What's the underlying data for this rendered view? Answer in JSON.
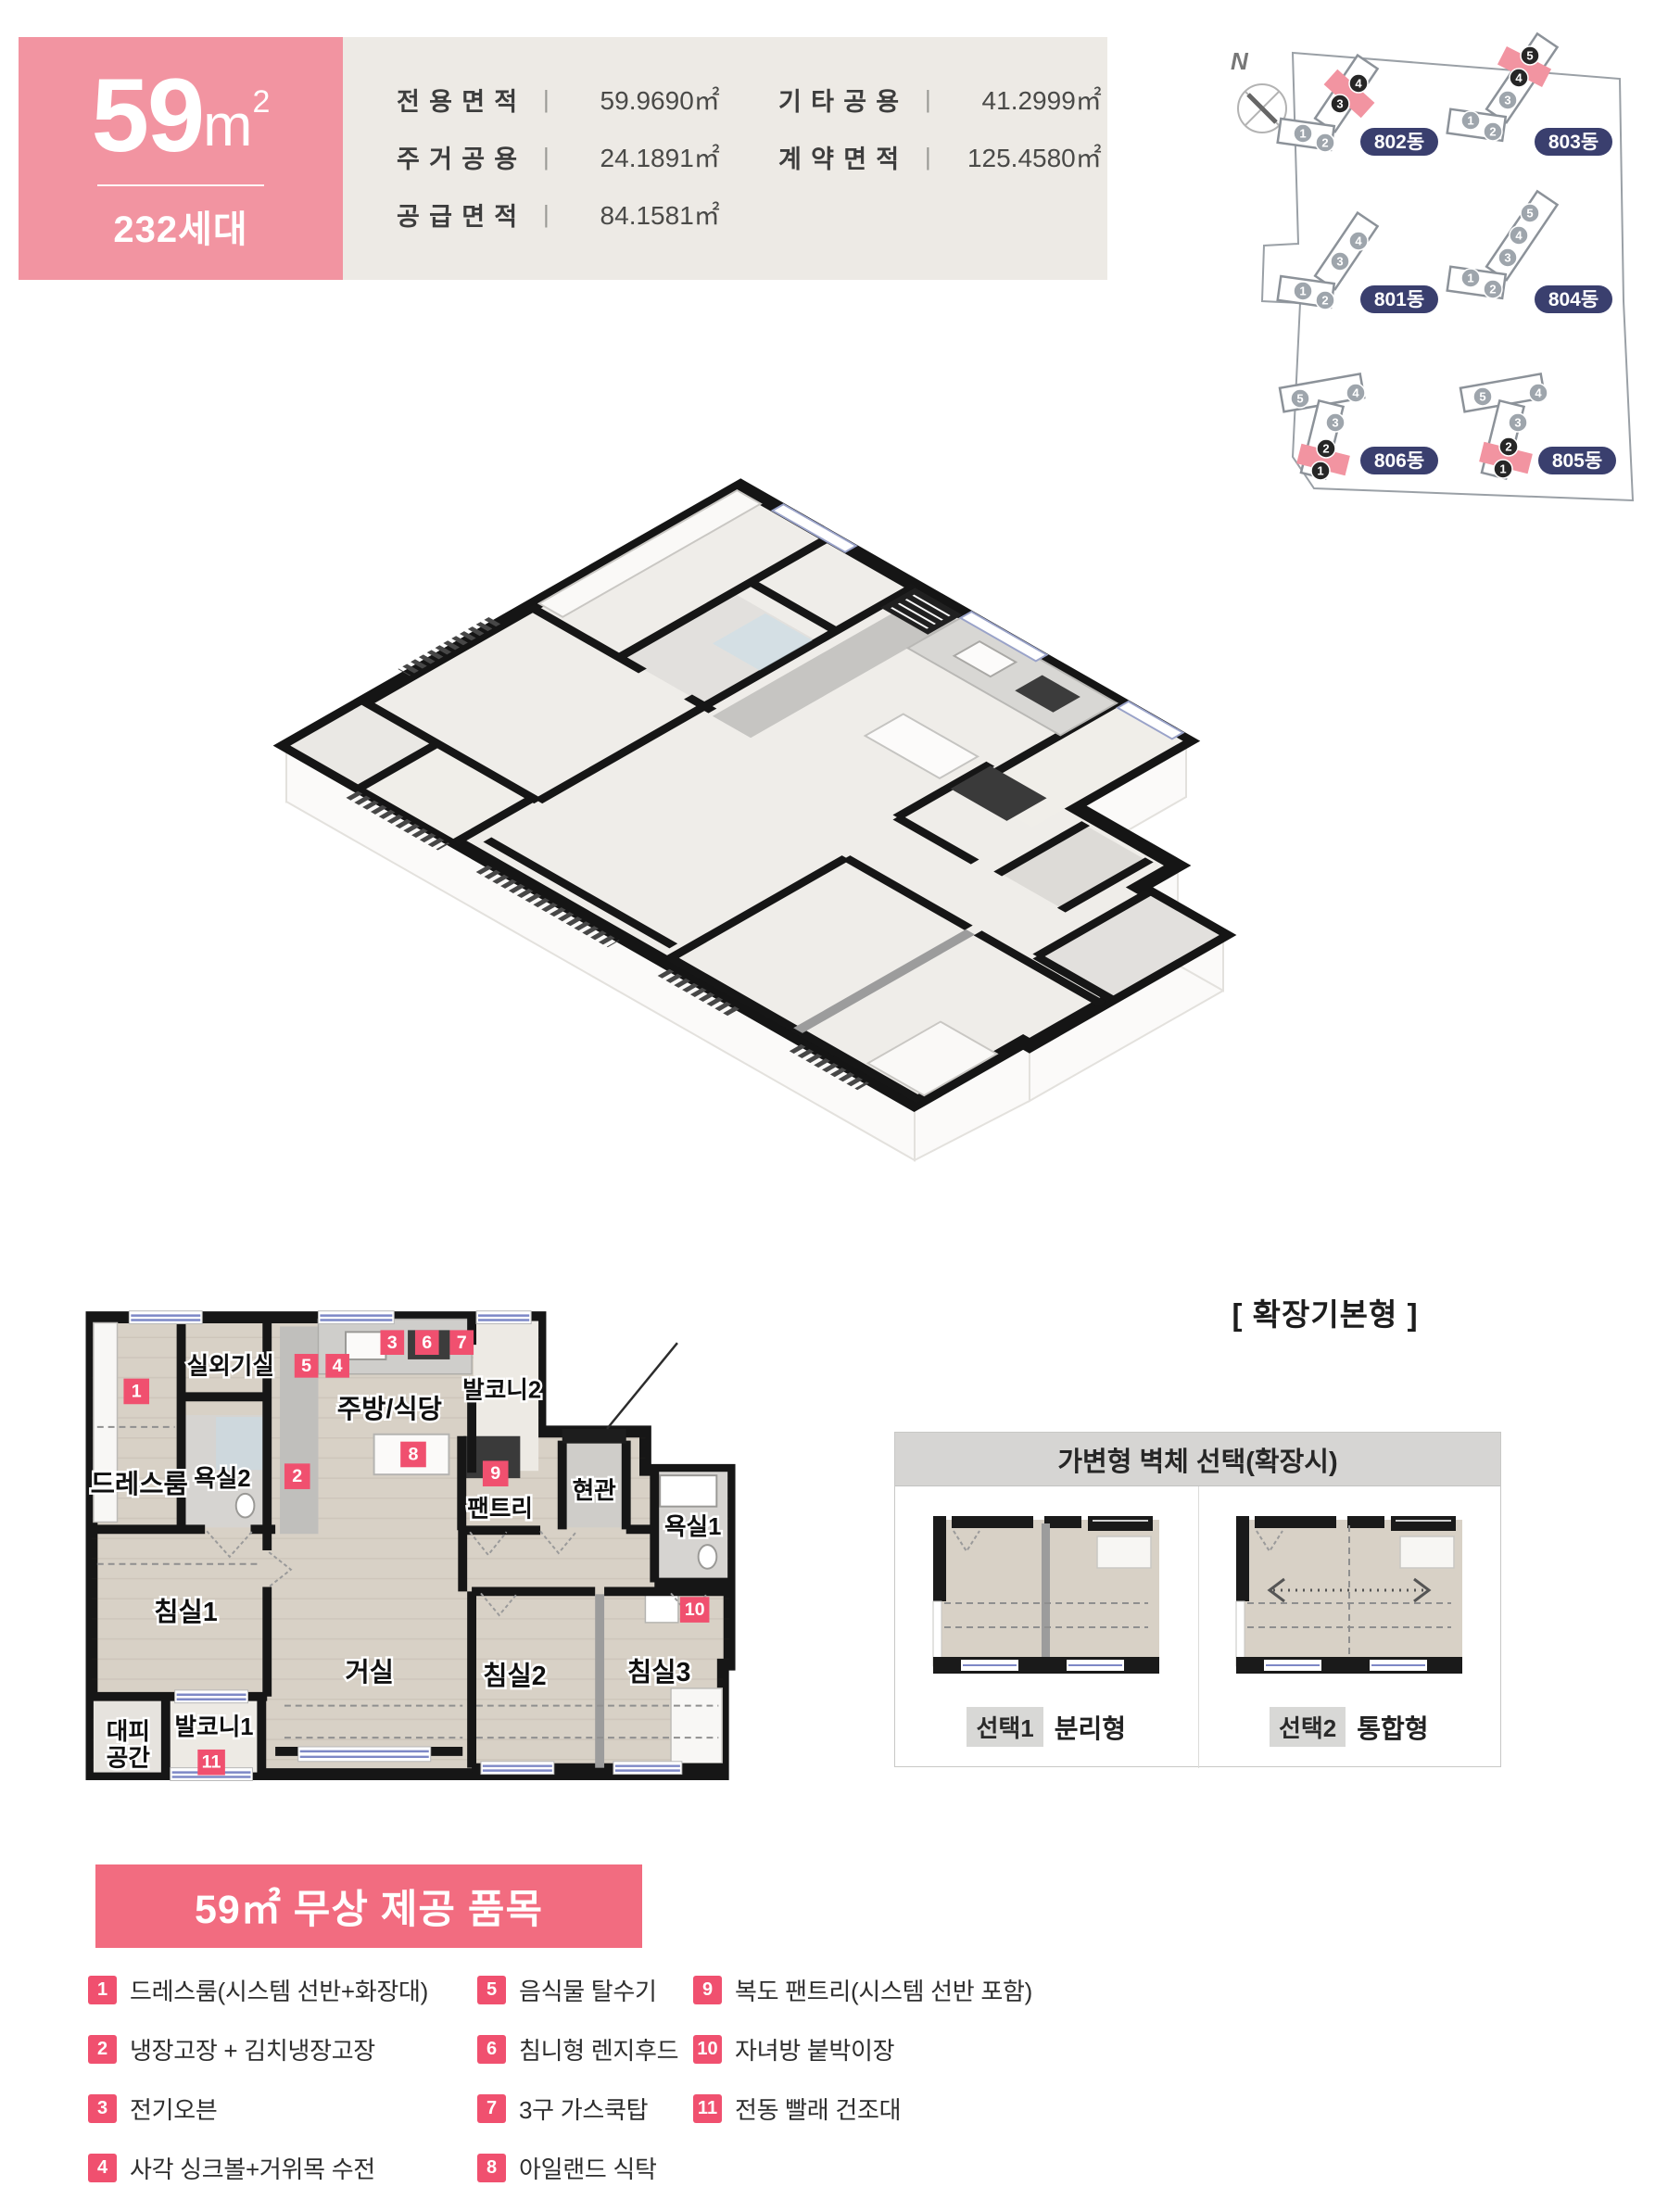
{
  "theme": {
    "accent_pink": "#F294A1",
    "marker_pink": "#F0506F",
    "title_bar_pink": "#F26C80",
    "badge_navy": "#3A3F6E",
    "panel_beige": "#EDEAE5"
  },
  "header": {
    "area_value": "59",
    "area_unit": "m",
    "area_sup": "2",
    "units_count": "232세대",
    "info_left": [
      {
        "label": "전용면적",
        "value": "59.9690㎡"
      },
      {
        "label": "주거공용",
        "value": "24.1891㎡"
      },
      {
        "label": "공급면적",
        "value": "84.1581㎡"
      }
    ],
    "info_right": [
      {
        "label": "기타공용",
        "value": "41.2999㎡"
      },
      {
        "label": "계약면적",
        "value": "125.4580㎡"
      }
    ]
  },
  "site_map": {
    "compass": "N",
    "buildings": [
      {
        "label": "802동",
        "units": [
          "1",
          "2",
          "3",
          "4"
        ],
        "highlighted": [
          "3",
          "4"
        ]
      },
      {
        "label": "803동",
        "units": [
          "1",
          "2",
          "3",
          "4",
          "5"
        ],
        "highlighted": [
          "4",
          "5"
        ]
      },
      {
        "label": "801동",
        "units": [
          "1",
          "2",
          "3",
          "4"
        ],
        "highlighted": []
      },
      {
        "label": "804동",
        "units": [
          "1",
          "2",
          "3",
          "4",
          "5"
        ],
        "highlighted": []
      },
      {
        "label": "806동",
        "units": [
          "1",
          "2",
          "3",
          "4",
          "5"
        ],
        "highlighted": [
          "1",
          "2"
        ]
      },
      {
        "label": "805동",
        "units": [
          "1",
          "2",
          "3",
          "4",
          "5"
        ],
        "highlighted": [
          "1",
          "2"
        ]
      }
    ]
  },
  "plan3d": {
    "caption": "[ 확장기본형 ]"
  },
  "plan2d": {
    "labels": {
      "outdoor_unit": "실외기실",
      "dressroom": "드레스룸",
      "bath2": "욕실2",
      "kitchen": "주방/식당",
      "balcony2": "발코니2",
      "pantry": "팬트리",
      "entrance": "현관",
      "bath1": "욕실1",
      "bed1": "침실1",
      "living": "거실",
      "bed2": "침실2",
      "bed3": "침실3",
      "refuge1": "대피",
      "refuge2": "공간",
      "balcony1": "발코니1"
    },
    "markers": [
      "1",
      "2",
      "3",
      "4",
      "5",
      "6",
      "7",
      "8",
      "9",
      "10",
      "11"
    ]
  },
  "wall_option": {
    "title": "가변형 벽체 선택(확장시)",
    "options": [
      {
        "tag": "선택1",
        "name": "분리형"
      },
      {
        "tag": "선택2",
        "name": "통합형"
      }
    ]
  },
  "free_items": {
    "title": "59㎡ 무상 제공 품목",
    "items": [
      {
        "num": "1",
        "text": "드레스룸(시스템 선반+화장대)"
      },
      {
        "num": "2",
        "text": "냉장고장 + 김치냉장고장"
      },
      {
        "num": "3",
        "text": "전기오븐"
      },
      {
        "num": "4",
        "text": "사각 싱크볼+거위목 수전"
      },
      {
        "num": "5",
        "text": "음식물 탈수기"
      },
      {
        "num": "6",
        "text": "침니형 렌지후드"
      },
      {
        "num": "7",
        "text": "3구 가스쿡탑"
      },
      {
        "num": "8",
        "text": "아일랜드 식탁"
      },
      {
        "num": "9",
        "text": "복도 팬트리(시스템 선반 포함)"
      },
      {
        "num": "10",
        "text": "자녀방 붙박이장"
      },
      {
        "num": "11",
        "text": "전동 빨래 건조대"
      }
    ]
  }
}
